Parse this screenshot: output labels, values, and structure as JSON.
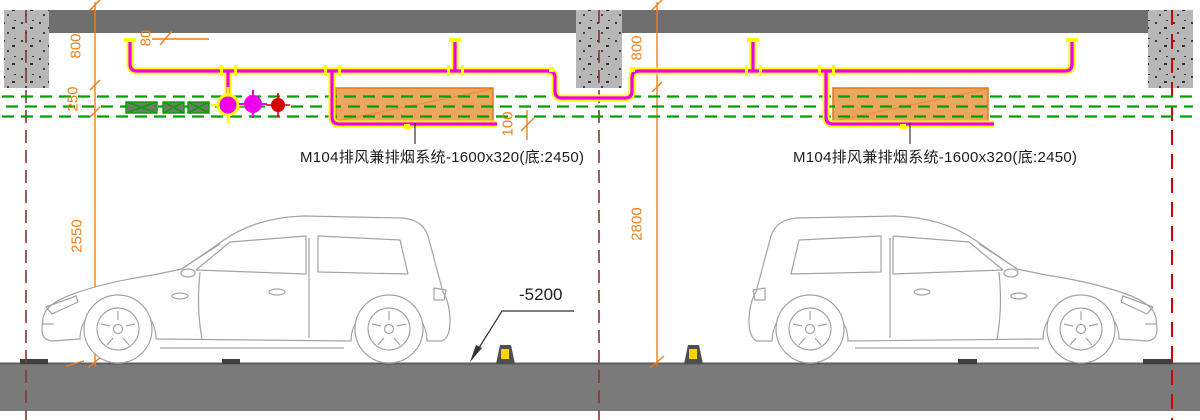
{
  "drawing": {
    "duct_label_1": "M104排风兼排烟系统-1600x320(底:2450)",
    "duct_label_2": "M104排风兼排烟系统-1600x320(底:2450)",
    "level_label": "-5200",
    "dimensions": {
      "left_800": "800",
      "left_250": "250",
      "left_2550": "2550",
      "top_80": "80",
      "duct_100": "100",
      "right_800": "800",
      "right_2800": "2800"
    }
  },
  "symbols": [
    {
      "name": "valve-symbol-crosshair-yellow-magenta"
    },
    {
      "name": "valve-symbol-crosshair-magenta"
    },
    {
      "name": "valve-symbol-crosshair-red"
    }
  ],
  "colors": {
    "dimension_orange": "#ef7f1a",
    "pipe_magenta": "#ee00ee",
    "pipe_edge_yellow": "#ffff00",
    "duct_fill": "#eda55f",
    "duct_border": "#e07818",
    "green_dashed": "#00a000",
    "hatch_fill": "#6b7d62",
    "ceiling_slab": "#6f6f6f",
    "column": "#b7b7b7",
    "floor": "#7a7a7a",
    "axis_dark_red": "#8a3333",
    "axis_bright_red": "#d40000",
    "wheelstop_yellow": "#ffd400"
  }
}
